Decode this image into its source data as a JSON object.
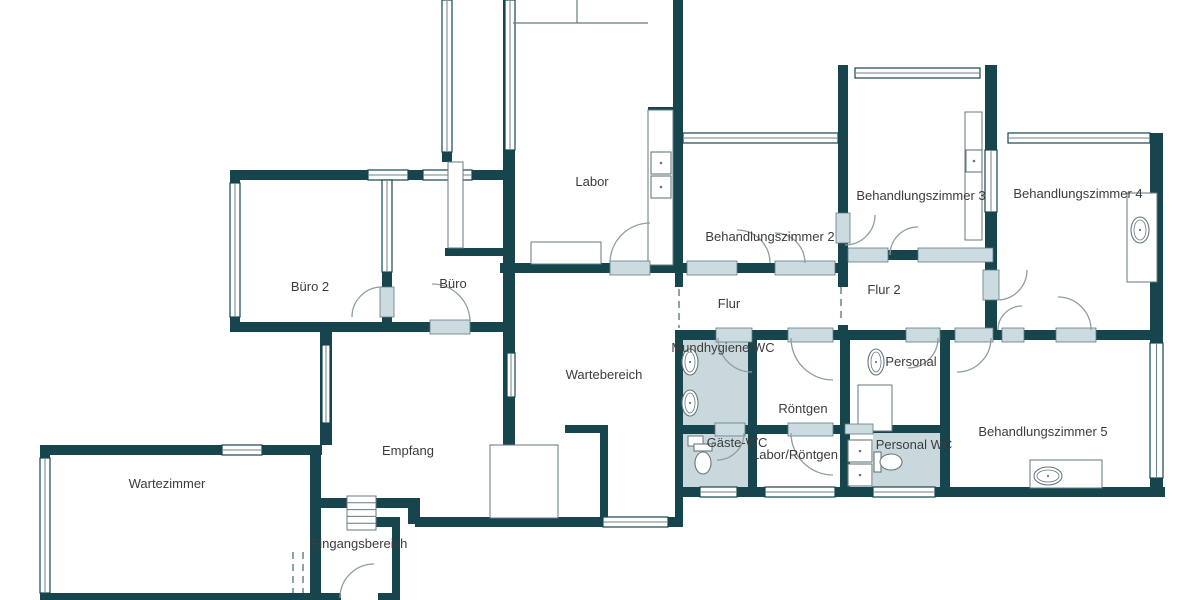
{
  "canvas": {
    "width": 1200,
    "height": 600
  },
  "colors": {
    "background": "#ffffff",
    "wall": "#16454e",
    "window_fill": "#ffffff",
    "window_line": "#6d8287",
    "door_sill": "#ccdbdf",
    "wc_room_fill": "#c9d8dc",
    "fixture_line": "#66797e",
    "arc_line": "#8d9da1",
    "dash_line": "#5e7c82",
    "label_text": "#3c3c3c"
  },
  "labels": {
    "font_size": 13
  },
  "rooms": [
    {
      "id": "labor",
      "label": "Labor",
      "cx": 592,
      "cy": 186
    },
    {
      "id": "buero2",
      "label": "Büro 2",
      "cx": 310,
      "cy": 291
    },
    {
      "id": "buero",
      "label": "Büro",
      "cx": 453,
      "cy": 288
    },
    {
      "id": "behandlungszimmer2",
      "label": "Behandlungszimmer 2",
      "cx": 770,
      "cy": 241
    },
    {
      "id": "behandlungszimmer3",
      "label": "Behandlungszimmer 3",
      "cx": 921,
      "cy": 200
    },
    {
      "id": "behandlungszimmer4",
      "label": "Behandlungszimmer 4",
      "cx": 1078,
      "cy": 198
    },
    {
      "id": "flur",
      "label": "Flur",
      "cx": 729,
      "cy": 308
    },
    {
      "id": "flur2",
      "label": "Flur 2",
      "cx": 884,
      "cy": 294
    },
    {
      "id": "wartebereich",
      "label": "Wartebereich",
      "cx": 604,
      "cy": 379
    },
    {
      "id": "mundhygiene-wc",
      "label": "Mundhygiene/WC",
      "cx": 723,
      "cy": 352
    },
    {
      "id": "personal",
      "label": "Personal",
      "cx": 911,
      "cy": 366
    },
    {
      "id": "roentgen",
      "label": "Röntgen",
      "cx": 803,
      "cy": 413
    },
    {
      "id": "gaeste-wc",
      "label": "Gäste-WC",
      "cx": 737,
      "cy": 447
    },
    {
      "id": "labor-roentgen",
      "label": "Labor/Röntgen",
      "cx": 795,
      "cy": 459
    },
    {
      "id": "personal-wc",
      "label": "Personal WC",
      "cx": 914,
      "cy": 449
    },
    {
      "id": "behandlungszimmer5",
      "label": "Behandlungszimmer 5",
      "cx": 1043,
      "cy": 436
    },
    {
      "id": "empfang",
      "label": "Empfang",
      "cx": 408,
      "cy": 455
    },
    {
      "id": "wartezimmer",
      "label": "Wartezimmer",
      "cx": 167,
      "cy": 488
    },
    {
      "id": "eingangsbereich",
      "label": "Eingangsbereich",
      "cx": 359,
      "cy": 548
    }
  ],
  "room_fills": [
    {
      "room": "mundhygiene-wc",
      "rect": [
        683,
        338,
        65,
        87
      ]
    },
    {
      "room": "gaeste-wc",
      "rect": [
        683,
        433,
        65,
        54
      ]
    },
    {
      "room": "personal-wc",
      "rect": [
        873,
        433,
        67,
        54
      ]
    }
  ],
  "walls": [
    [
      230,
      170,
      282,
      10
    ],
    [
      230,
      170,
      10,
      162
    ],
    [
      382,
      172,
      10,
      158
    ],
    [
      230,
      322,
      284,
      10
    ],
    [
      503,
      0,
      12,
      445
    ],
    [
      673,
      0,
      10,
      273
    ],
    [
      500,
      263,
      345,
      10
    ],
    [
      442,
      152,
      10,
      10
    ],
    [
      445,
      248,
      60,
      8
    ],
    [
      838,
      65,
      10,
      148
    ],
    [
      838,
      243,
      10,
      44
    ],
    [
      838,
      325,
      10,
      15
    ],
    [
      845,
      250,
      150,
      10
    ],
    [
      985,
      65,
      12,
      85
    ],
    [
      985,
      212,
      12,
      58
    ],
    [
      985,
      300,
      12,
      40
    ],
    [
      683,
      330,
      480,
      10
    ],
    [
      675,
      273,
      8,
      14
    ],
    [
      675,
      330,
      8,
      197
    ],
    [
      748,
      338,
      9,
      149
    ],
    [
      840,
      338,
      10,
      159
    ],
    [
      845,
      425,
      100,
      8
    ],
    [
      683,
      425,
      160,
      9
    ],
    [
      940,
      330,
      10,
      167
    ],
    [
      675,
      487,
      490,
      10
    ],
    [
      1150,
      133,
      13,
      215
    ],
    [
      1150,
      478,
      13,
      19
    ],
    [
      320,
      330,
      12,
      115
    ],
    [
      40,
      445,
      282,
      10
    ],
    [
      40,
      445,
      10,
      155
    ],
    [
      310,
      448,
      11,
      152
    ],
    [
      40,
      593,
      272,
      7
    ],
    [
      415,
      517,
      268,
      10
    ],
    [
      313,
      498,
      34,
      10
    ],
    [
      376,
      498,
      39,
      10
    ],
    [
      408,
      498,
      12,
      26
    ],
    [
      392,
      517,
      8,
      83
    ],
    [
      376,
      517,
      24,
      10
    ],
    [
      313,
      593,
      28,
      7
    ],
    [
      378,
      593,
      22,
      7
    ],
    [
      565,
      425,
      43,
      8
    ],
    [
      600,
      425,
      8,
      95
    ],
    [
      648,
      107,
      27,
      4
    ]
  ],
  "windows": [
    [
      368,
      170,
      40,
      10,
      "h"
    ],
    [
      423,
      170,
      49,
      10,
      "h"
    ],
    [
      230,
      183,
      10,
      134,
      "v"
    ],
    [
      442,
      0,
      10,
      152,
      "v"
    ],
    [
      505,
      0,
      10,
      150,
      "v"
    ],
    [
      683,
      133,
      155,
      10,
      "h"
    ],
    [
      855,
      68,
      125,
      10,
      "h"
    ],
    [
      1008,
      133,
      142,
      10,
      "h"
    ],
    [
      985,
      150,
      12,
      62,
      "v"
    ],
    [
      1150,
      343,
      13,
      135,
      "v"
    ],
    [
      322,
      345,
      8,
      78,
      "v"
    ],
    [
      507,
      353,
      8,
      44,
      "v"
    ],
    [
      382,
      180,
      10,
      92,
      "v"
    ],
    [
      40,
      458,
      10,
      135,
      "v"
    ],
    [
      222,
      445,
      40,
      10,
      "h"
    ],
    [
      603,
      517,
      65,
      10,
      "h"
    ],
    [
      700,
      487,
      37,
      10,
      "h"
    ],
    [
      765,
      487,
      70,
      10,
      "h"
    ],
    [
      873,
      487,
      62,
      10,
      "h"
    ]
  ],
  "door_sills": [
    [
      610,
      261,
      40,
      14
    ],
    [
      430,
      320,
      40,
      14
    ],
    [
      380,
      287,
      14,
      30
    ],
    [
      687,
      261,
      50,
      14
    ],
    [
      775,
      261,
      60,
      14
    ],
    [
      836,
      213,
      14,
      30
    ],
    [
      848,
      248,
      40,
      14
    ],
    [
      918,
      248,
      75,
      14
    ],
    [
      906,
      328,
      34,
      14
    ],
    [
      955,
      328,
      38,
      14
    ],
    [
      983,
      270,
      16,
      30
    ],
    [
      1002,
      328,
      22,
      14
    ],
    [
      1056,
      328,
      40,
      14
    ],
    [
      716,
      328,
      36,
      14
    ],
    [
      788,
      328,
      45,
      14
    ],
    [
      788,
      423,
      45,
      13
    ],
    [
      715,
      423,
      30,
      13
    ],
    [
      845,
      424,
      28,
      10
    ]
  ],
  "door_arcs": [
    [
      610,
      263,
      40,
      650,
      223,
      1
    ],
    [
      470,
      322,
      38,
      432,
      284,
      0
    ],
    [
      382,
      287,
      30,
      352,
      317,
      0
    ],
    [
      737,
      230,
      33,
      770,
      263,
      1
    ],
    [
      775,
      233,
      30,
      805,
      263,
      1
    ],
    [
      845,
      245,
      30,
      875,
      215,
      0
    ],
    [
      918,
      227,
      28,
      890,
      255,
      0
    ],
    [
      938,
      338,
      30,
      908,
      368,
      1
    ],
    [
      991,
      338,
      34,
      957,
      372,
      1
    ],
    [
      997,
      300,
      30,
      1027,
      270,
      0
    ],
    [
      1022,
      306,
      24,
      998,
      330,
      0
    ],
    [
      1058,
      297,
      33,
      1091,
      330,
      1
    ],
    [
      718,
      338,
      34,
      752,
      372,
      0
    ],
    [
      791,
      338,
      42,
      833,
      380,
      0
    ],
    [
      791,
      433,
      42,
      833,
      475,
      0
    ],
    [
      744,
      433,
      27,
      717,
      460,
      1
    ],
    [
      340,
      598,
      34,
      374,
      564,
      1
    ]
  ],
  "thin_rects": [
    [
      648,
      110,
      25,
      155
    ],
    [
      531,
      242,
      70,
      22
    ],
    [
      448,
      162,
      15,
      86
    ],
    [
      965,
      112,
      17,
      128
    ],
    [
      1127,
      193,
      30,
      89
    ],
    [
      1030,
      460,
      72,
      28
    ],
    [
      858,
      385,
      34,
      46
    ],
    [
      490,
      445,
      68,
      73
    ]
  ],
  "thin_lines": [
    [
      513,
      23,
      648,
      23
    ],
    [
      577,
      0,
      577,
      23
    ]
  ],
  "dashed_openings": [
    [
      841,
      287,
      841,
      323
    ],
    [
      679,
      289,
      679,
      328
    ],
    [
      293,
      552,
      293,
      593
    ],
    [
      303,
      552,
      303,
      593
    ]
  ],
  "stairs": {
    "rect": [
      347,
      496,
      29,
      34
    ],
    "steps": 5
  },
  "fixtures": {
    "square_sinks": [
      [
        651,
        152,
        20,
        22
      ],
      [
        651,
        176,
        20,
        22
      ],
      [
        966,
        150,
        16,
        22
      ],
      [
        848,
        440,
        24,
        22
      ],
      [
        848,
        464,
        24,
        22
      ]
    ],
    "oval_sinks": [
      [
        690,
        362,
        8,
        13
      ],
      [
        690,
        403,
        8,
        13
      ],
      [
        876,
        362,
        8,
        13
      ],
      [
        1140,
        230,
        9,
        13
      ],
      [
        1048,
        476,
        14,
        9
      ]
    ],
    "basins": [
      [
        688,
        436,
        15,
        10
      ]
    ],
    "toilets": [
      {
        "tank": [
          694,
          444,
          18,
          7
        ],
        "bowl": [
          703,
          463,
          8,
          11
        ]
      },
      {
        "tank": [
          874,
          452,
          7,
          20
        ],
        "bowl": [
          891,
          462,
          11,
          8
        ]
      }
    ]
  }
}
